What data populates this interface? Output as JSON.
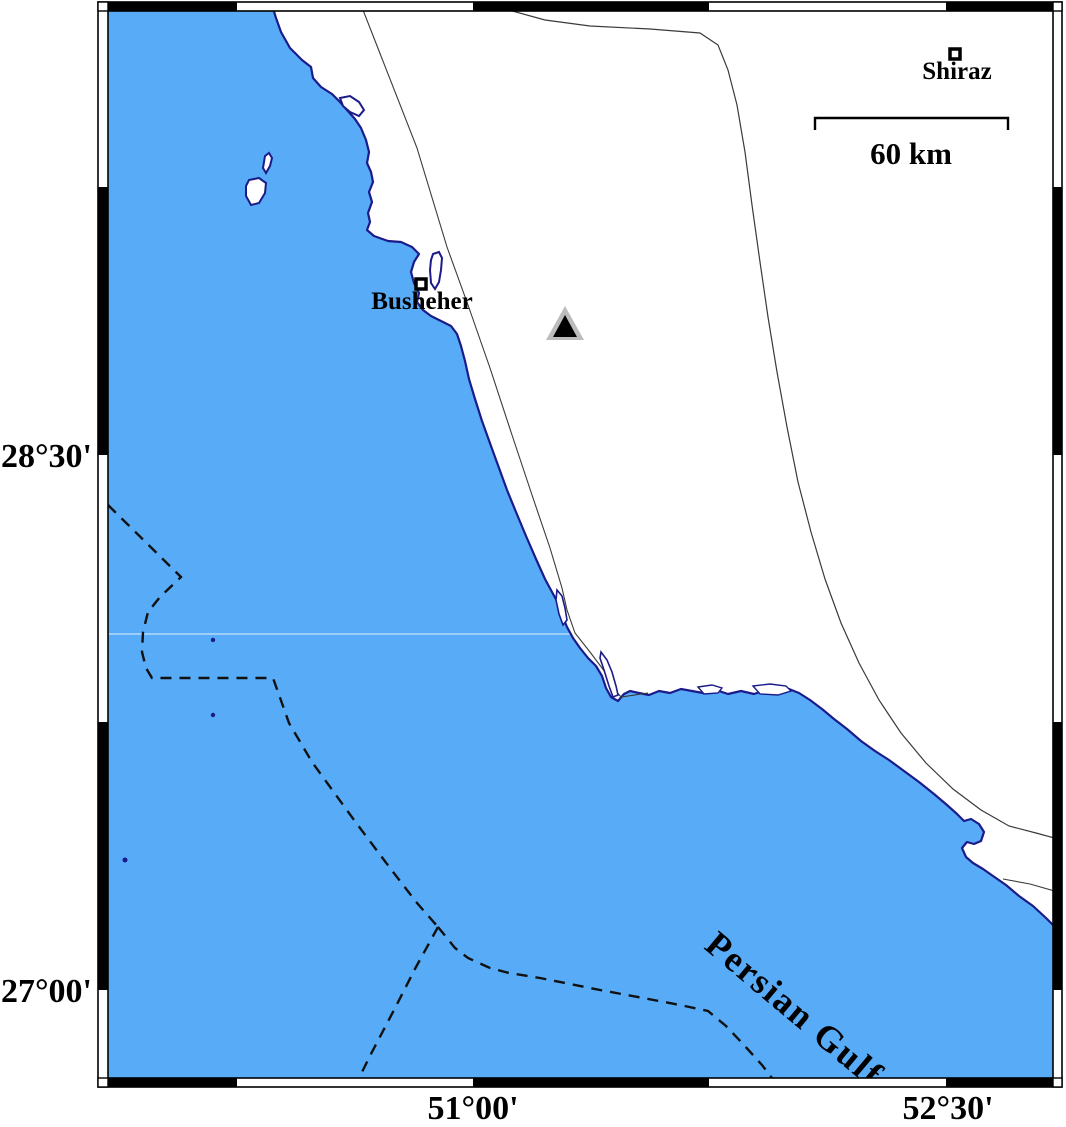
{
  "map": {
    "sea_label": "Persian Gulf",
    "cities": {
      "busheher": "Busheher",
      "shiraz": "Shiraz"
    },
    "scale_bar_label": "60 km",
    "axis_left": [
      "28°30'",
      "27°00'"
    ],
    "axis_bottom": [
      "51°00'",
      "52°30'"
    ],
    "symbols": {
      "station_marker": "filled-triangle-with-gray-halo",
      "city_marker": "open-square"
    },
    "colors": {
      "sea": "#57abf7",
      "coastline": "#1b1b8a",
      "frame_black": "#000000",
      "land": "#ffffff",
      "station_inner": "#000000",
      "station_halo": "#bcbcbc",
      "boundary_dashed": "#111111",
      "thin_border": "#3a3a3a"
    }
  }
}
